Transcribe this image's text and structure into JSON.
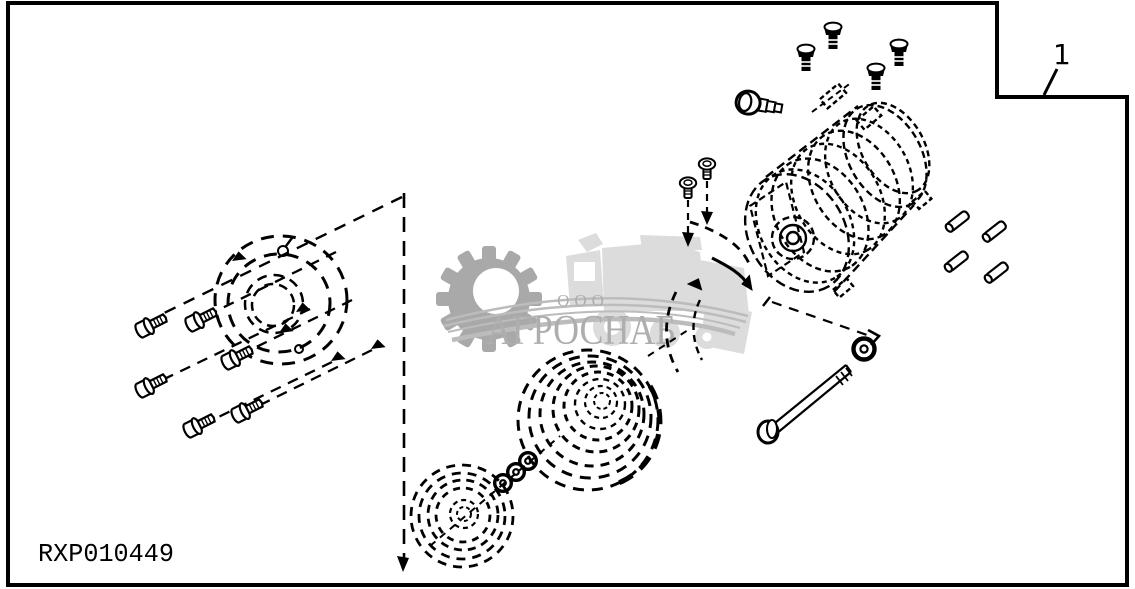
{
  "window": {
    "background": "#ffffff",
    "border_color": "#000000"
  },
  "callout": {
    "label": "1"
  },
  "footer": {
    "drawing_code": "RXP010449"
  },
  "watermark": {
    "company_type": "ООО",
    "company_name": "АГРОСНАБ",
    "gear_color": "#a9a9a9",
    "tractor_color": "#dcdcdc",
    "swoosh_color": "#bcbcbc",
    "text_color": "#aeaeae"
  },
  "diagram": {
    "type": "exploded-parts-diagram",
    "line_color": "#000000",
    "components": [
      {
        "name": "mounting-flange",
        "style": "hidden-dashed"
      },
      {
        "name": "flange-hex-bolts",
        "count": 6
      },
      {
        "name": "clutch-pulley-small",
        "style": "hidden-dashed"
      },
      {
        "name": "clutch-pulley-large",
        "style": "hidden-dashed"
      },
      {
        "name": "shaft-washers",
        "count": 3
      },
      {
        "name": "compressor-body",
        "style": "sketch"
      },
      {
        "name": "top-mounting-bolts",
        "count": 4
      },
      {
        "name": "oil-plug-fitting",
        "count": 1
      },
      {
        "name": "side-screws",
        "count": 2
      },
      {
        "name": "dowel-pins",
        "count": 4
      },
      {
        "name": "through-bolt-with-washer",
        "count": 1
      }
    ]
  }
}
